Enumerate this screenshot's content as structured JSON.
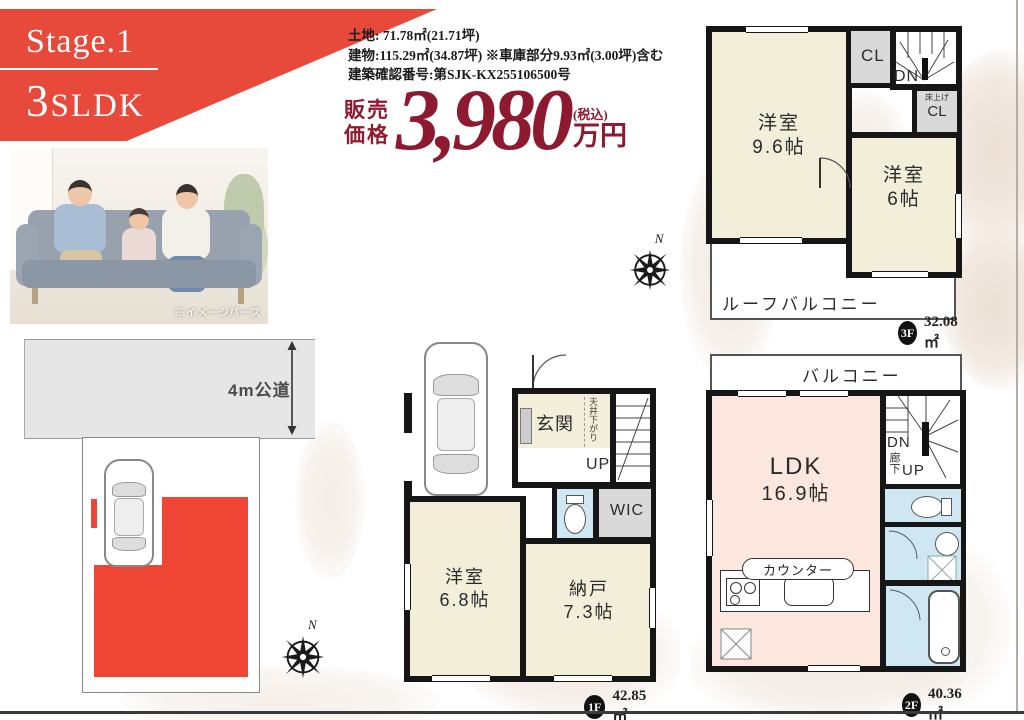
{
  "banner": {
    "stage": "Stage.1",
    "layout_big": "3",
    "layout_rest": "SLDK"
  },
  "photo": {
    "caption": "※イメージパース"
  },
  "property": {
    "land": "土地:  71.78㎡(21.71坪)",
    "building": "建物:115.29㎡(34.87坪) ※車庫部分9.93㎡(3.00坪)含む",
    "permit": "建築確認番号:第SJK-KX255106500号"
  },
  "price": {
    "label1": "販売",
    "label2": "価格",
    "amount": "3,980",
    "tax": "(税込)",
    "unit": "万円"
  },
  "site": {
    "road": "4m公道",
    "north": "N"
  },
  "f3": {
    "north": "N",
    "room_a": "洋室",
    "room_a_size": "9.6帖",
    "cl": "CL",
    "dn": "DN",
    "raised": "床上げ",
    "raised_cl": "CL",
    "room_b": "洋室",
    "room_b_size": "6帖",
    "roof_balcony": "ルーフバルコニー",
    "badge": "3F",
    "area": "32.08㎡"
  },
  "f1": {
    "entrance": "玄関",
    "ceiling_note": "天井下がり",
    "up": "UP",
    "wic": "WIC",
    "room_a": "洋室",
    "room_a_size": "6.8帖",
    "room_b": "納戸",
    "room_b_size": "7.3帖",
    "badge": "1F",
    "area": "42.85㎡"
  },
  "f2": {
    "balcony": "バルコニー",
    "ldk": "LDK",
    "ldk_size": "16.9帖",
    "dn": "DN",
    "hall": "廊下",
    "up": "UP",
    "counter": "カウンター",
    "badge": "2F",
    "area": "40.36㎡"
  },
  "colors": {
    "banner_red": "#e7493a",
    "footprint_red": "#ee4534",
    "price_red": "#8e1a2f",
    "room_cream": "#f3eeda",
    "ldk_pink": "#fbe7dd",
    "wet_blue": "#cfe7f2",
    "closet_gray": "#d9d9d9",
    "wall_black": "#161616"
  }
}
